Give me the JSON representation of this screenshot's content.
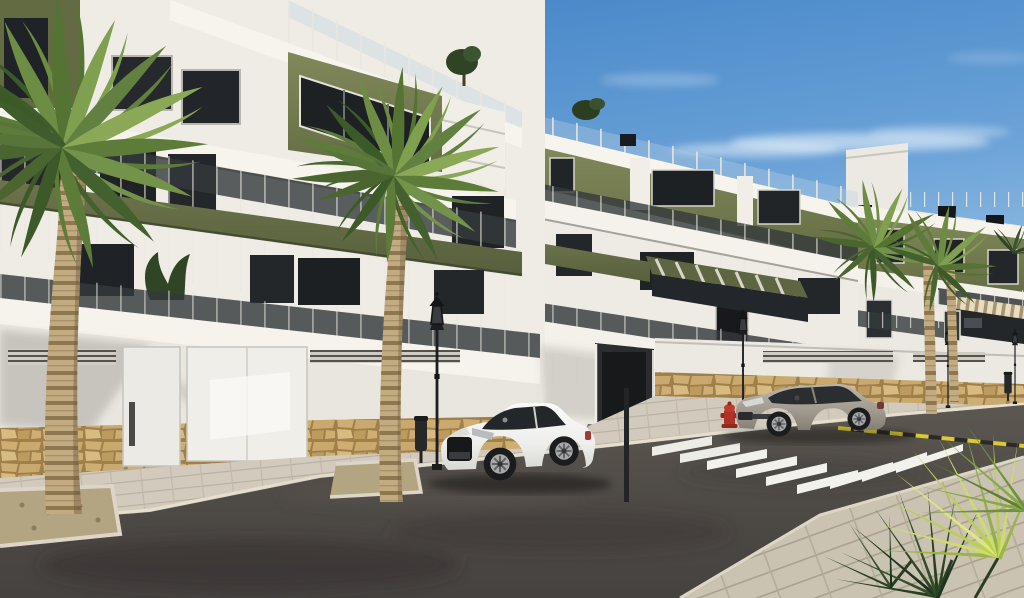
{
  "scene": {
    "setting": "Sunny street view of a modern white apartment complex with olive-green accents, palm trees, parked cars and a zebra crosswalk",
    "palette": {
      "sky_top": "#3e7fc4",
      "sky_horizon": "#cfe3f2",
      "wall_white_lit": "#f3f0e9",
      "wall_white_shade": "#d9d6cf",
      "accent_olive": "#7a8153",
      "accent_olive_dark": "#5d6640",
      "glass_dark": "#2b3033",
      "stone_tan": "#c2a067",
      "paver_light": "#d2cbbd",
      "asphalt": "#4e4a45",
      "crosswalk_white": "#f2f1ec",
      "curbline_yellow": "#d9cb32",
      "car_white": "#f3f3f1",
      "car_beige": "#9b948a",
      "hydrant_red": "#b03126",
      "palm_green": "#5d7c39",
      "fan_palm_bright": "#cddd6a",
      "trunk_tan": "#c2ab81"
    },
    "objects": [
      {
        "name": "sky",
        "desc": "blue gradient with wispy clouds"
      },
      {
        "name": "apartment-block-left",
        "desc": "3-storey white block, olive panels, glass balconies"
      },
      {
        "name": "apartment-block-middle",
        "desc": "receding block with roof terrace and pergola"
      },
      {
        "name": "apartment-block-right",
        "desc": "far block with striped awning"
      },
      {
        "name": "garage-wall",
        "desc": "white street wall with vents, two garage doors, stone base"
      },
      {
        "name": "driveway-entrance",
        "desc": "dark recessed ramp between wall sections"
      },
      {
        "name": "street",
        "desc": "asphalt road with stains"
      },
      {
        "name": "crosswalk",
        "stripes": 9
      },
      {
        "name": "road-marking",
        "desc": "yellow-black dashed curb line"
      },
      {
        "name": "white-coupe-car",
        "color": "#f3f3f1"
      },
      {
        "name": "beige-coupe-car",
        "color": "#9b948a"
      },
      {
        "name": "street-lamps",
        "count": 4
      },
      {
        "name": "litter-bins",
        "count": 2
      },
      {
        "name": "fire-hydrant",
        "color": "#b03126"
      },
      {
        "name": "palm-trees",
        "count": 5
      },
      {
        "name": "foreground-fan-palm",
        "desc": "bright fan palm, bottom right corner"
      },
      {
        "name": "planters",
        "count": 2
      },
      {
        "name": "sidewalk",
        "desc": "paved walkways both sides"
      }
    ]
  }
}
